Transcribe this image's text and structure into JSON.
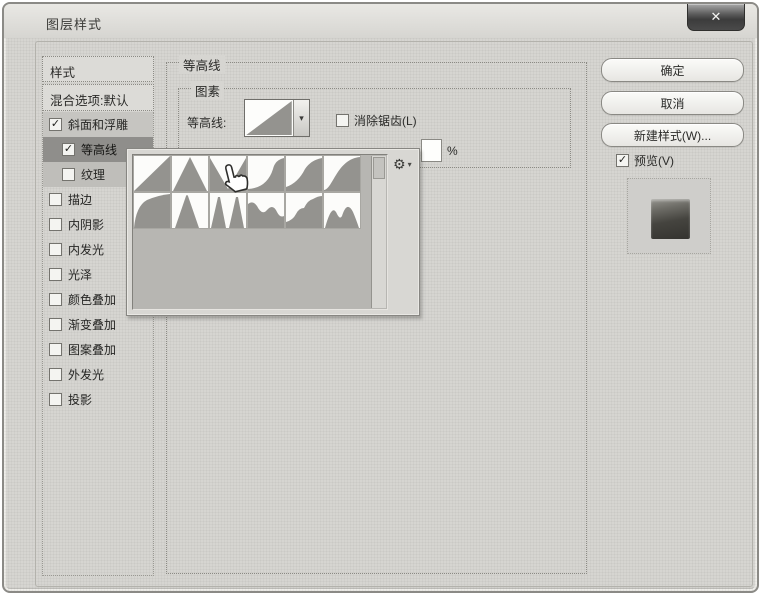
{
  "window": {
    "title": "图层样式",
    "close_glyph": "✕"
  },
  "ui": {
    "check_glyph": "✓",
    "dropdown_arrow": "▾",
    "gear_glyph": "⚙",
    "gear_caret": "▾"
  },
  "sidebar": {
    "styles_label": "样式",
    "blending_label": "混合选项:默认",
    "items": [
      {
        "key": "bevel-emboss",
        "label": "斜面和浮雕",
        "checked": true,
        "indent": false,
        "highlight": "light"
      },
      {
        "key": "contour",
        "label": "等高线",
        "checked": true,
        "indent": true,
        "highlight": "dark"
      },
      {
        "key": "texture",
        "label": "纹理",
        "checked": false,
        "indent": true,
        "highlight": "mid"
      },
      {
        "key": "stroke",
        "label": "描边",
        "checked": false,
        "indent": false,
        "highlight": "none"
      },
      {
        "key": "inner-shadow",
        "label": "内阴影",
        "checked": false,
        "indent": false,
        "highlight": "none"
      },
      {
        "key": "inner-glow",
        "label": "内发光",
        "checked": false,
        "indent": false,
        "highlight": "none"
      },
      {
        "key": "satin",
        "label": "光泽",
        "checked": false,
        "indent": false,
        "highlight": "none"
      },
      {
        "key": "color-overlay",
        "label": "颜色叠加",
        "checked": false,
        "indent": false,
        "highlight": "none"
      },
      {
        "key": "gradient-overlay",
        "label": "渐变叠加",
        "checked": false,
        "indent": false,
        "highlight": "none"
      },
      {
        "key": "pattern-overlay",
        "label": "图案叠加",
        "checked": false,
        "indent": false,
        "highlight": "none"
      },
      {
        "key": "outer-glow",
        "label": "外发光",
        "checked": false,
        "indent": false,
        "highlight": "none"
      },
      {
        "key": "drop-shadow",
        "label": "投影",
        "checked": false,
        "indent": false,
        "highlight": "none"
      }
    ]
  },
  "panel": {
    "group_title": "等高线",
    "elements_title": "图素",
    "contour_label": "等高线:",
    "selected_contour": "linear",
    "antialias_label": "消除锯齿(L)",
    "antialias_checked": false,
    "range_unit": "%"
  },
  "picker": {
    "presets": [
      "linear",
      "cone",
      "cone-inverted",
      "cove-deep",
      "cove-shallow",
      "gaussian",
      "half-round",
      "ring",
      "ring-double",
      "rolling-slope-descending",
      "rounded-steps",
      "sawtooth"
    ]
  },
  "actions": {
    "ok": "确定",
    "cancel": "取消",
    "new_style": "新建样式(W)...",
    "preview_label": "预览(V)",
    "preview_checked": true
  },
  "colors": {
    "contour_fill": "#94938f",
    "tile_bg": "#fcfcfa"
  }
}
